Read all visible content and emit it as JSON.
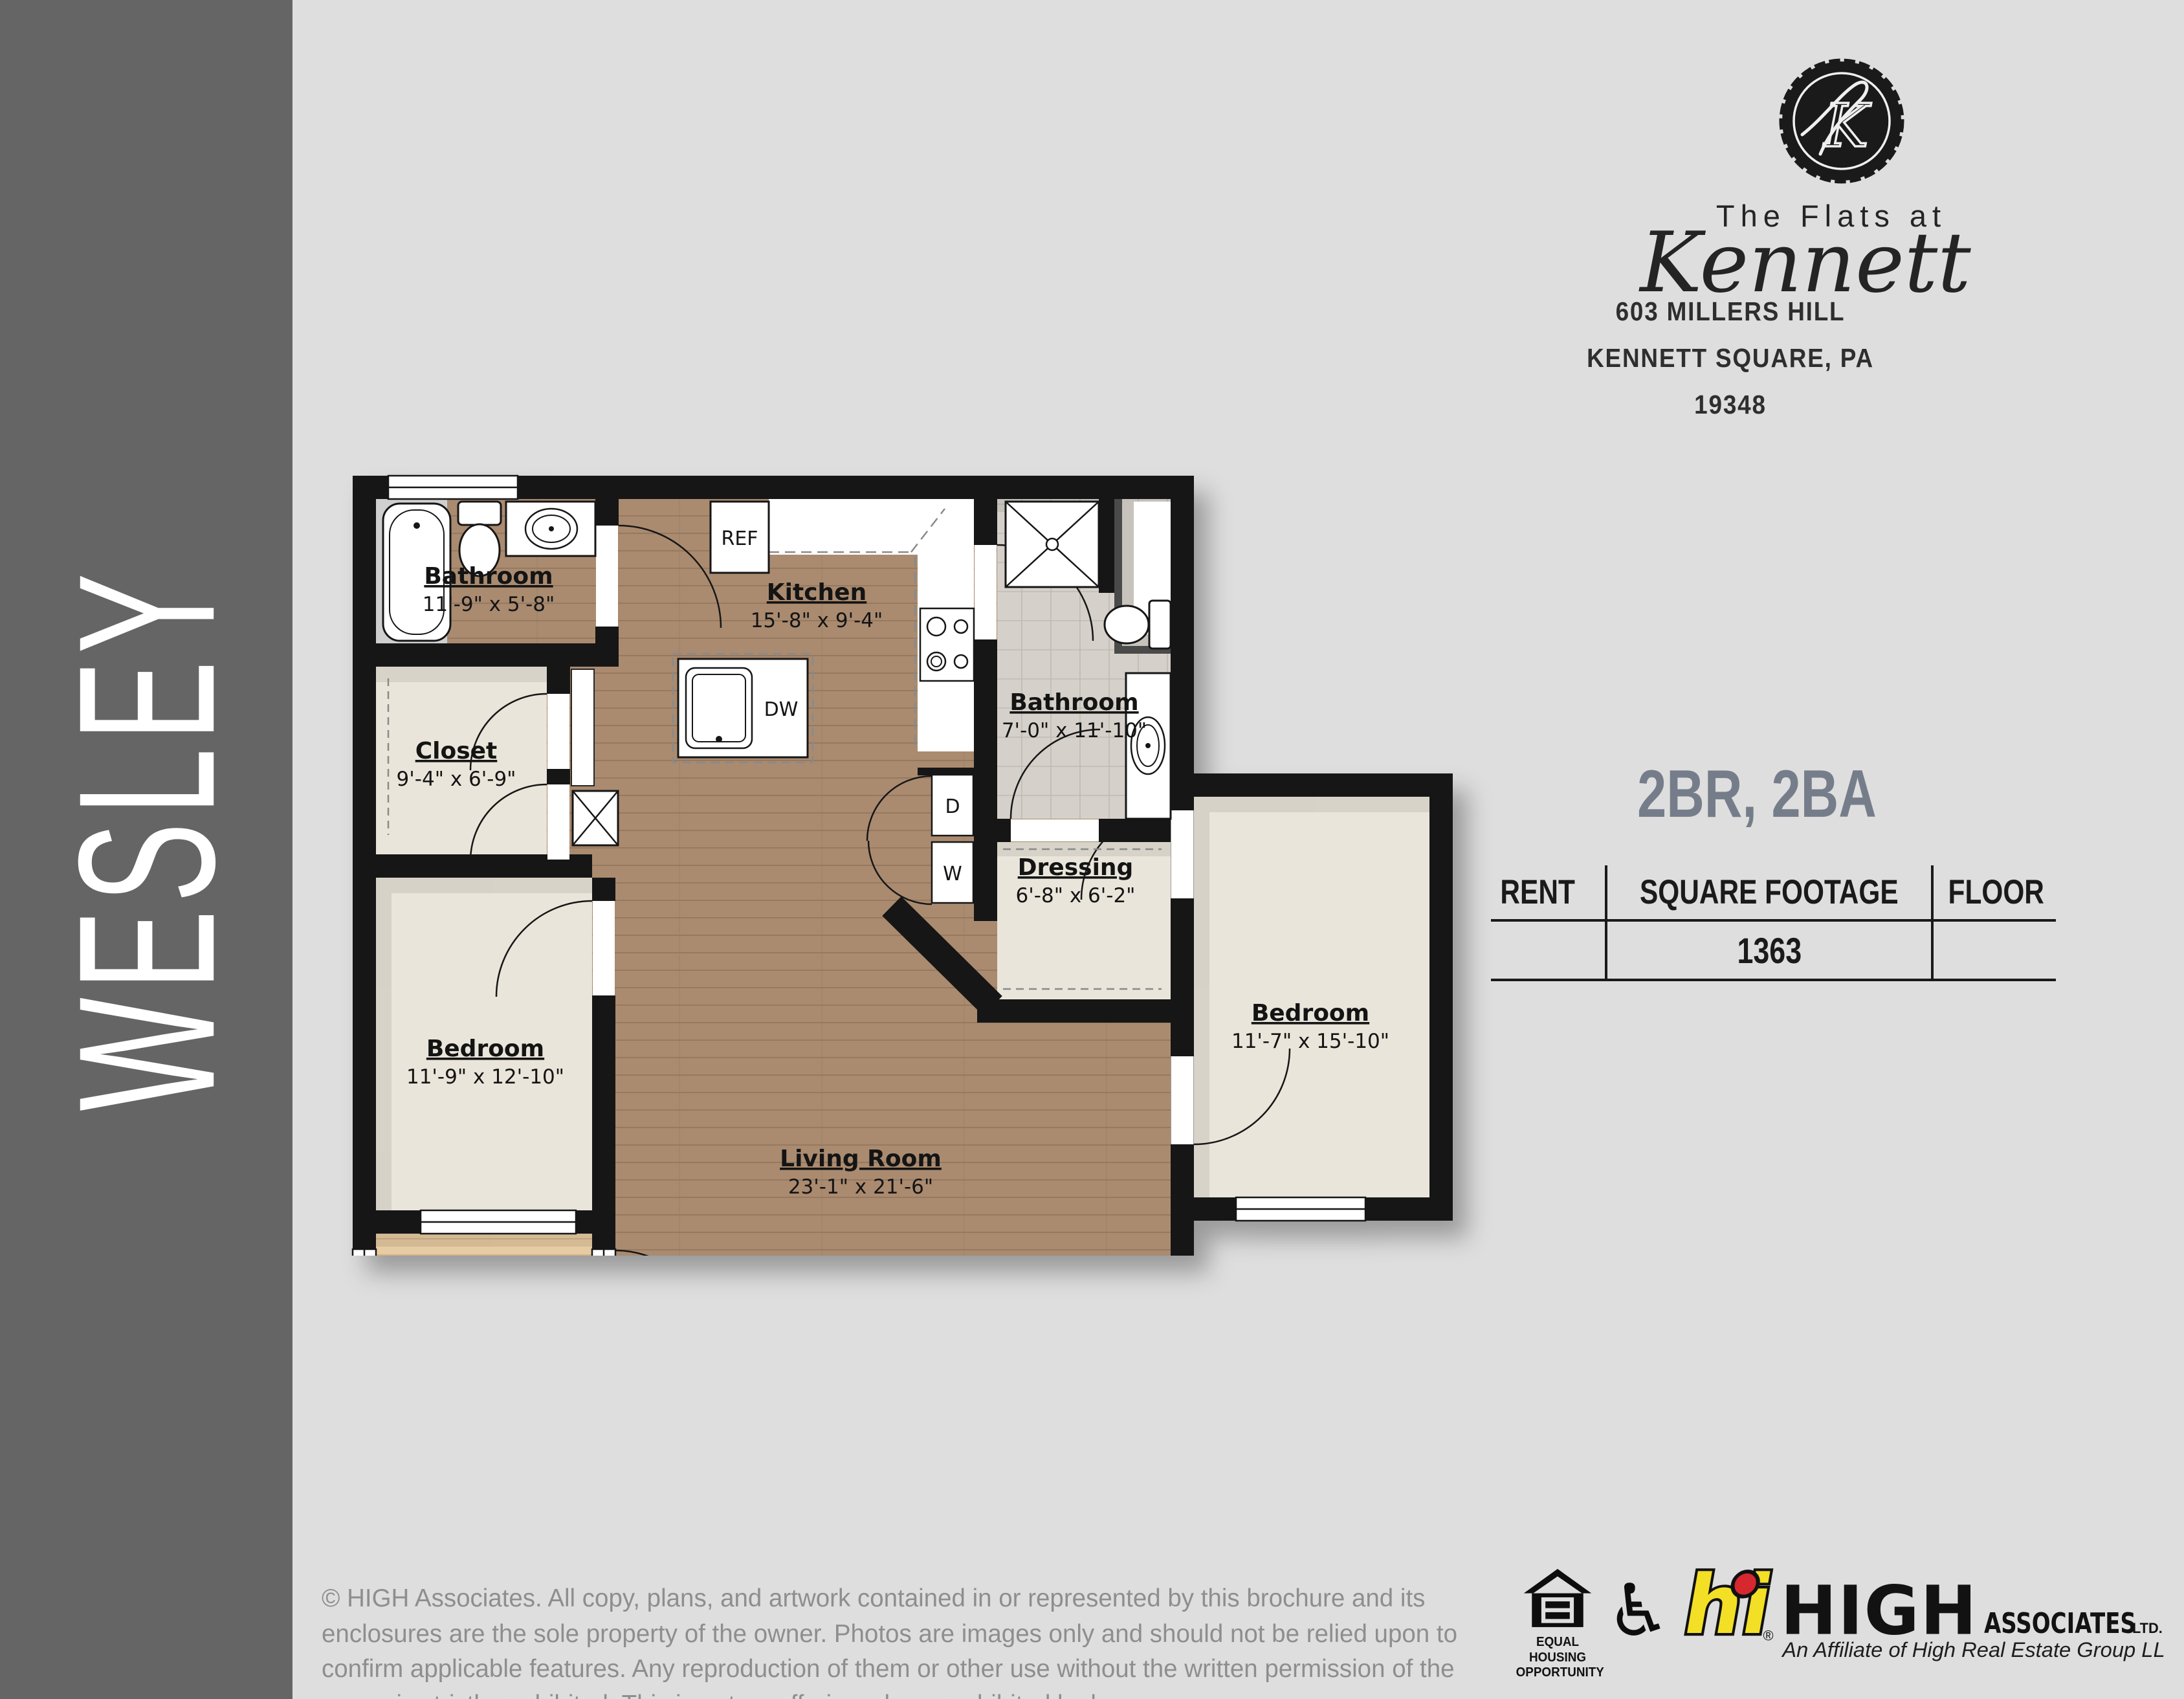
{
  "sidebar": {
    "label": "WESLEY",
    "background": "#656565",
    "text_color": "#ffffff"
  },
  "brand": {
    "monogram": "K",
    "name_line": "The Flats at",
    "name_script": "Kennett",
    "address_line1": "603 MILLERS HILL",
    "address_line2": "KENNETT SQUARE, PA 19348"
  },
  "unit": {
    "type_heading": "2BR, 2BA",
    "table": {
      "headers": [
        "RENT",
        "SQUARE FOOTAGE",
        "FLOOR"
      ],
      "rows": [
        {
          "rent": "",
          "square_footage": "1363",
          "floor": ""
        }
      ]
    }
  },
  "floorplan": {
    "rooms": [
      {
        "name": "Bathroom",
        "dims": "11'-9\" x 5'-8\""
      },
      {
        "name": "Kitchen",
        "dims": "15'-8\" x 9'-4\""
      },
      {
        "name": "Closet",
        "dims": "9'-4\" x 6'-9\""
      },
      {
        "name": "Bathroom",
        "dims": "7'-0\" x 11'-10\""
      },
      {
        "name": "Dressing",
        "dims": "6'-8\" x 6'-2\""
      },
      {
        "name": "Bedroom",
        "dims": "11'-9\" x 12'-10\""
      },
      {
        "name": "Bedroom",
        "dims": "11'-7\" x 15'-10\""
      },
      {
        "name": "Living Room",
        "dims": "23'-1\" x 21'-6\""
      },
      {
        "name": "Balcony",
        "dims": ""
      }
    ],
    "appliances": {
      "refrigerator": "REF",
      "dishwasher": "DW",
      "dryer": "D",
      "washer": "W"
    },
    "colors": {
      "wood": "#aa8b70",
      "cream": "#eae5da",
      "tile": "#d5d1ca",
      "balcony": "#e6cba3",
      "wall": "#161616"
    }
  },
  "footer": {
    "copyright": "© HIGH Associates. All copy, plans, and artwork contained in or represented by this brochure and its enclosures are the sole property of the owner. Photos are images only and should not be relied upon to confirm applicable features. Any reproduction of them or other use without the written permission of the owner is strictly prohibited. This is not an offering where prohibited by law.",
    "equal_housing": {
      "line1": "EQUAL HOUSING",
      "line2": "OPPORTUNITY"
    },
    "high_logo": {
      "hi": "hi",
      "reg": "®",
      "name": "HIGH",
      "suffix": "ASSOCIATES",
      "ltd": "LTD.",
      "tagline": "An Affiliate of High Real Estate Group LLC",
      "yellow": "#f3df25",
      "red": "#d7282f"
    }
  }
}
